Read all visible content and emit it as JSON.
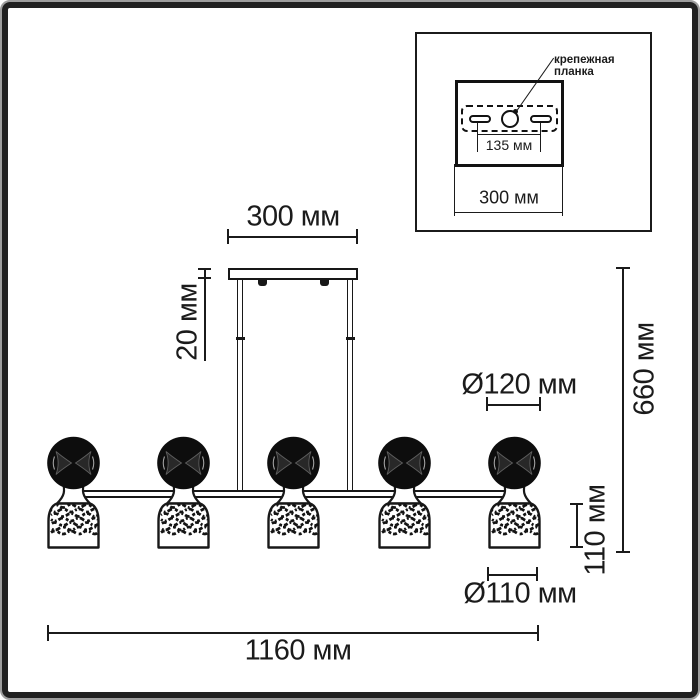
{
  "inset": {
    "callout_line1": "крепежная",
    "callout_line2": "планка",
    "hole_spacing": "135 мм",
    "plate_width": "300 мм"
  },
  "dimensions": {
    "canopy_width": "300 мм",
    "canopy_height": "20 мм",
    "overall_height": "660 мм",
    "sphere_diameter": "Ø120 мм",
    "head_height": "110 мм",
    "shade_diameter": "Ø110 мм",
    "overall_width": "1160 мм"
  },
  "fixture": {
    "lamp_count": 5
  },
  "colors": {
    "line": "#1b1b1b",
    "background": "#ffffff"
  }
}
